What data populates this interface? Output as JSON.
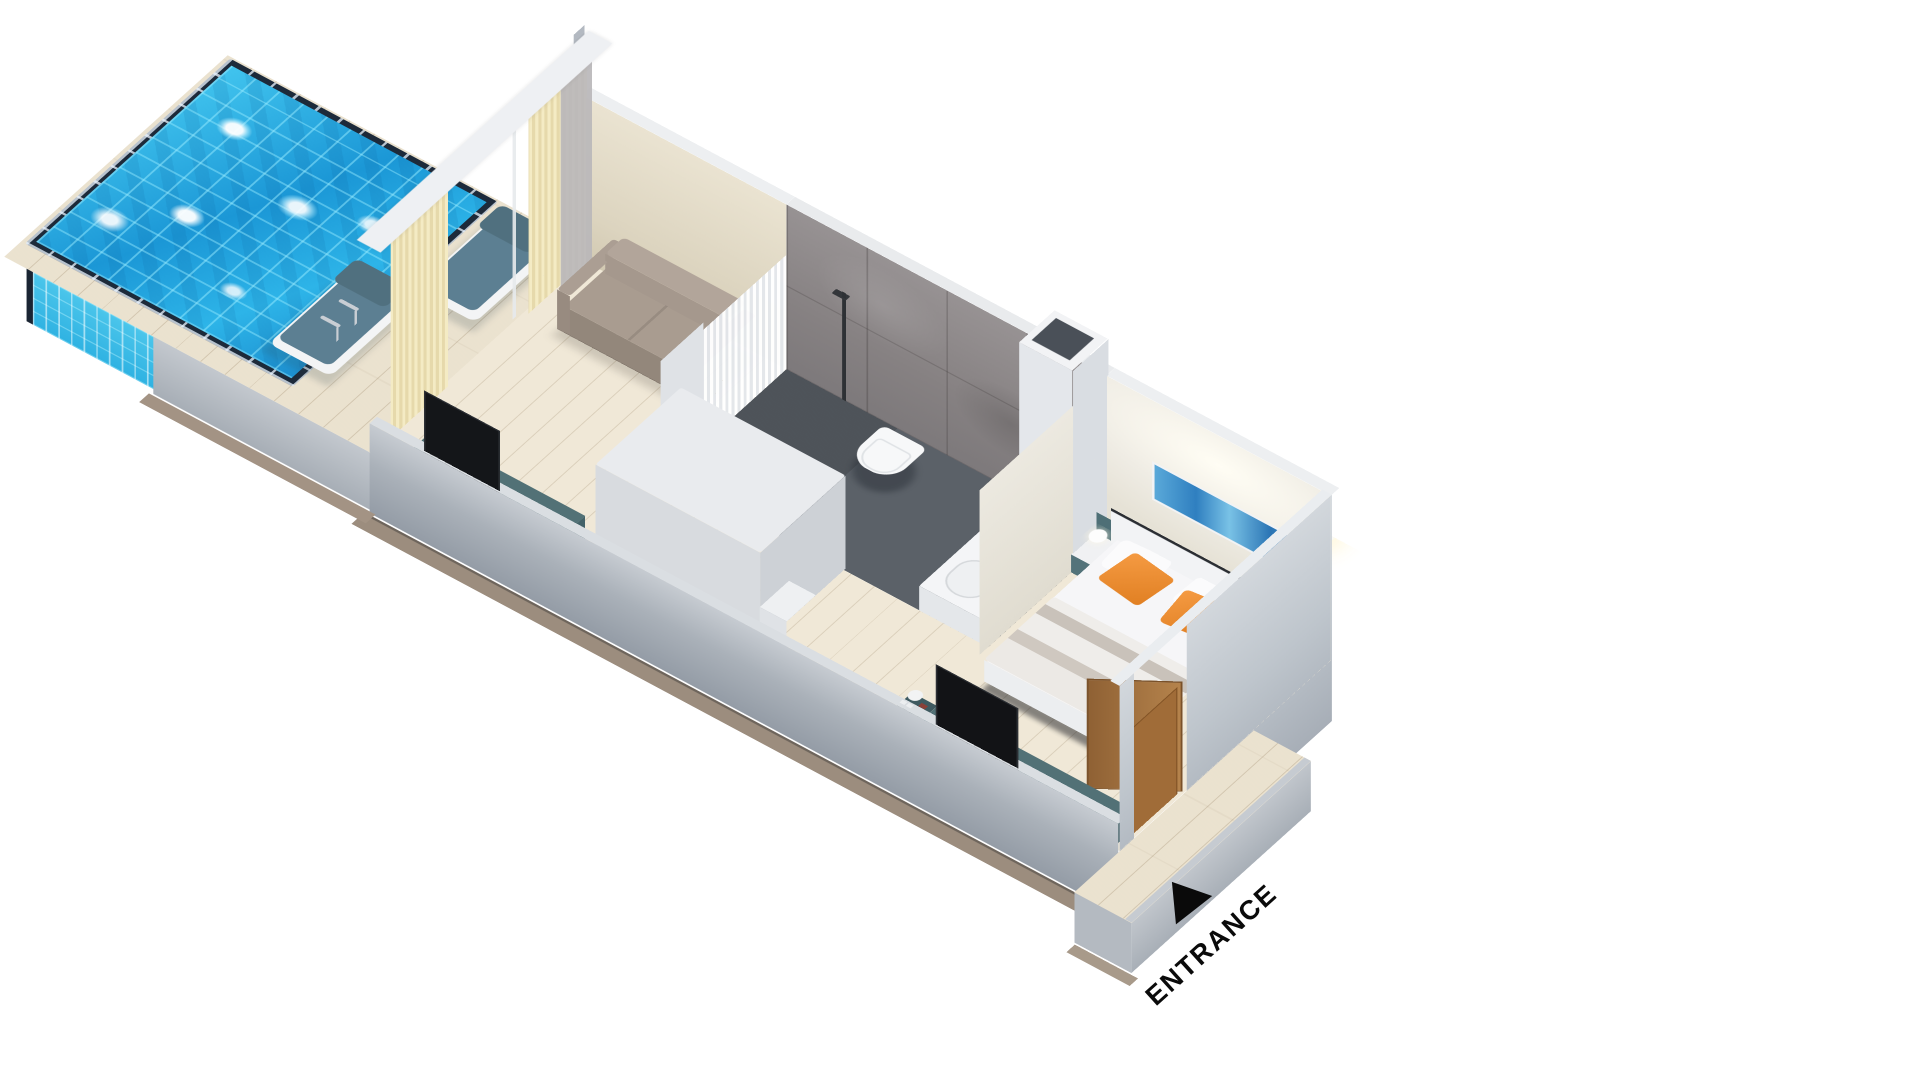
{
  "entrance": {
    "label": "ENTRANCE"
  },
  "icons": {
    "entrance_arrow": "triangle-up-arrow"
  },
  "colors": {
    "background": "#ffffff",
    "pool_water_base": "#23a7e0",
    "pool_water_highlight": "#8fe2f6",
    "pool_rim_dark": "#1d2a3a",
    "pool_light_glow": "#ffffff",
    "deck_wood": "#efe7d5",
    "interior_wood": "#f0e8d7",
    "wall_exterior_gray": "#aab1b9",
    "wall_interior_beige": "#e3dbc6",
    "bedroom_wall_white": "#efece4",
    "stone_tile_gray": "#8e8a8a",
    "bathroom_floor_slate": "#5b6168",
    "sofa_taupe": "#a99c90",
    "curtain_cream": "#f0e7bf",
    "sheer_curtain_gray": "#b9b7b9",
    "console_teal": "#527176",
    "tv_black": "#141619",
    "bed_linen_white": "#f6f6f8",
    "blanket_taupe": "#cfc8c0",
    "pillow_orange": "#ef8f35",
    "artwork_blue": "#2f7fc0",
    "door_wood_brown": "#a97843",
    "lounger_slate_blue": "#5c7f92",
    "entrance_text": "#0a0a0a"
  }
}
